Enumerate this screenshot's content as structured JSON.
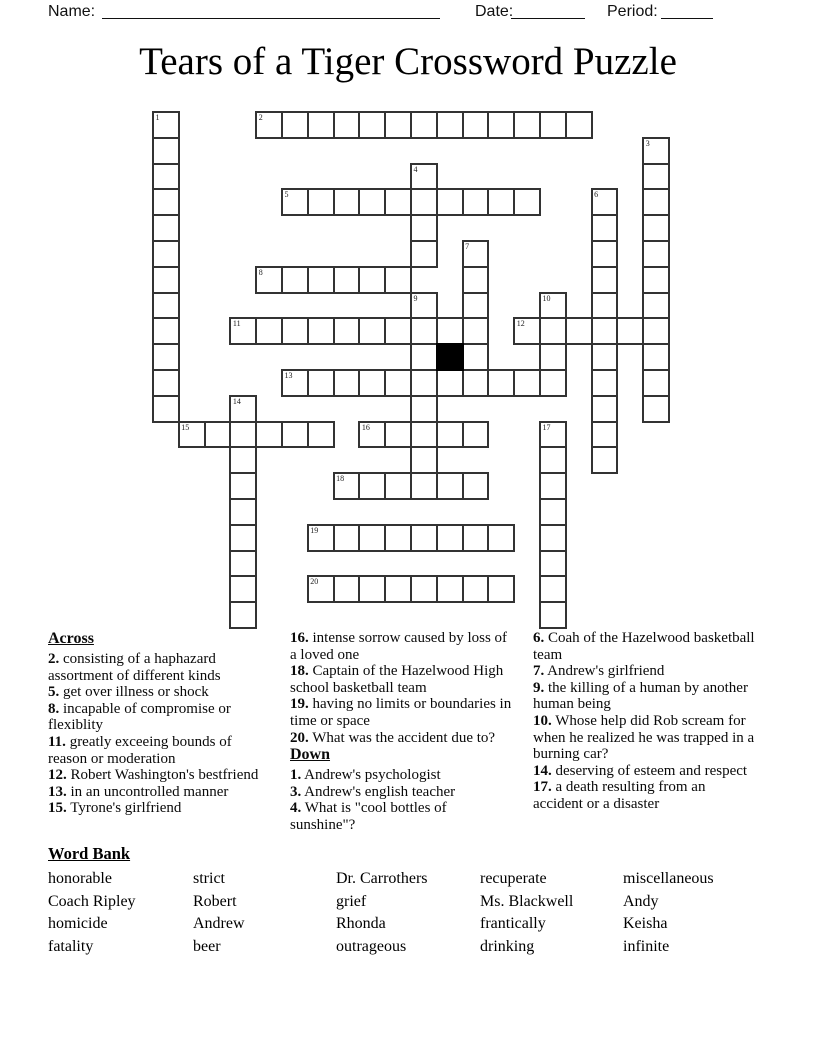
{
  "header": {
    "name_label": "Name:",
    "date_label": "Date:",
    "period_label": "Period:"
  },
  "title": "Tears of a Tiger Crossword Puzzle",
  "grid": {
    "rows": 20,
    "cols": 20,
    "across_runs": [
      [
        2,
        0,
        4,
        13
      ],
      [
        5,
        3,
        5,
        10
      ],
      [
        8,
        6,
        4,
        6
      ],
      [
        11,
        8,
        3,
        10
      ],
      [
        12,
        8,
        14,
        6
      ],
      [
        13,
        10,
        5,
        11
      ],
      [
        15,
        12,
        1,
        6
      ],
      [
        16,
        12,
        8,
        5
      ],
      [
        18,
        14,
        7,
        6
      ],
      [
        19,
        16,
        6,
        8
      ],
      [
        20,
        18,
        6,
        8
      ]
    ],
    "down_runs": [
      [
        1,
        0,
        0,
        12
      ],
      [
        3,
        1,
        19,
        11
      ],
      [
        4,
        2,
        10,
        4
      ],
      [
        6,
        3,
        17,
        11
      ],
      [
        7,
        5,
        12,
        6
      ],
      [
        9,
        7,
        10,
        8
      ],
      [
        10,
        7,
        15,
        4
      ],
      [
        14,
        11,
        3,
        9
      ],
      [
        17,
        12,
        15,
        8
      ]
    ],
    "black_cells": [
      [
        9,
        11
      ]
    ]
  },
  "clues": {
    "across_label": "Across",
    "down_label": "Down",
    "across": [
      {
        "num": "2.",
        "text": "consisting of a haphazard assortment of different kinds"
      },
      {
        "num": "5.",
        "text": "get over illness or shock"
      },
      {
        "num": "8.",
        "text": "incapable of compromise or flexiblity"
      },
      {
        "num": "11.",
        "text": "greatly exceeing bounds of reason or moderation"
      },
      {
        "num": "12.",
        "text": "Robert Washington's bestfriend"
      },
      {
        "num": "13.",
        "text": "in an uncontrolled manner"
      },
      {
        "num": "15.",
        "text": "Tyrone's girlfriend"
      },
      {
        "num": "16.",
        "text": "intense sorrow caused by loss of a loved one"
      },
      {
        "num": "18.",
        "text": "Captain of the Hazelwood High school basketball team"
      },
      {
        "num": "19.",
        "text": "having no limits or boundaries in time or space"
      },
      {
        "num": "20.",
        "text": "What was the accident due to?"
      }
    ],
    "down": [
      {
        "num": "1.",
        "text": "Andrew's psychologist"
      },
      {
        "num": "3.",
        "text": "Andrew's english teacher"
      },
      {
        "num": "4.",
        "text": "What is \"cool bottles of sunshine\"?"
      },
      {
        "num": "6.",
        "text": "Coah of the Hazelwood basketball team"
      },
      {
        "num": "7.",
        "text": "Andrew's girlfriend"
      },
      {
        "num": "9.",
        "text": "the killing of a human by another human being"
      },
      {
        "num": "10.",
        "text": "Whose help did Rob scream for when he realized he was trapped in a burning car?"
      },
      {
        "num": "14.",
        "text": "deserving of esteem and respect"
      },
      {
        "num": "17.",
        "text": "a death resulting from an accident or a disaster"
      }
    ]
  },
  "word_bank": {
    "label": "Word Bank",
    "columns": [
      [
        "honorable",
        "Coach Ripley",
        "homicide",
        "fatality"
      ],
      [
        "strict",
        "Robert",
        "Andrew",
        "beer"
      ],
      [
        "Dr. Carrothers",
        "grief",
        "Rhonda",
        "outrageous"
      ],
      [
        "recuperate",
        "Ms. Blackwell",
        "frantically",
        "drinking"
      ],
      [
        "miscellaneous",
        "Andy",
        "Keisha",
        "infinite"
      ]
    ]
  }
}
